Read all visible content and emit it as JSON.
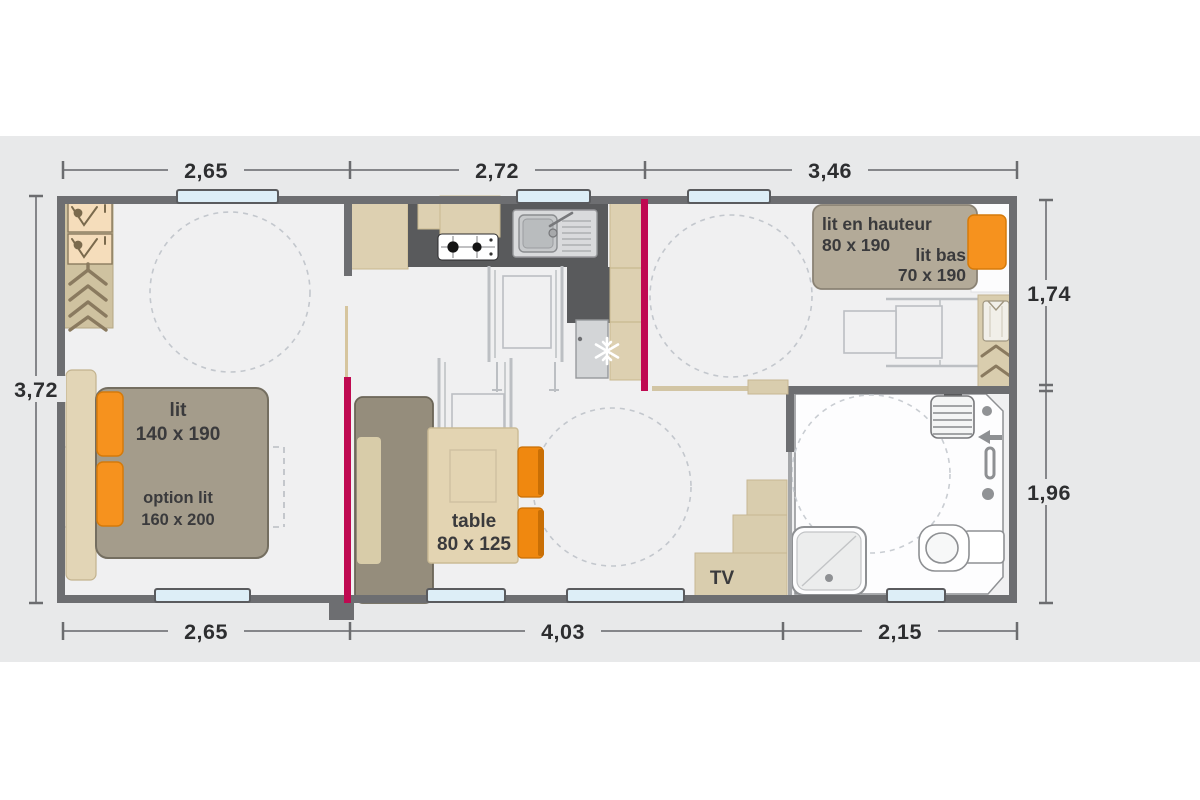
{
  "plan": {
    "dimensions": {
      "top": [
        "2,65",
        "2,72",
        "3,46"
      ],
      "bottom": [
        "2,65",
        "4,03",
        "2,15"
      ],
      "left": [
        "3,72"
      ],
      "right": [
        "1,74",
        "1,96"
      ]
    },
    "furniture": {
      "bed": {
        "name": "lit",
        "size": "140 x 190"
      },
      "bed_option": {
        "name": "option lit",
        "size": "160 x 200"
      },
      "table": {
        "name": "table",
        "size": "80 x 125"
      },
      "tv": {
        "name": "TV"
      },
      "bunk_bed": {
        "name": "lit en hauteur",
        "size": "80 x 190"
      },
      "low_bed": {
        "name": "lit bas",
        "size": "70 x 190"
      }
    },
    "colors": {
      "accent_orange": "#f6921e",
      "door_magenta": "#bf0a51",
      "wall_gray": "#6d6e71",
      "window_blue": "#ddeef7",
      "cabinet_beige": "#ddd0b1",
      "upholstery_taupe": "#a49c8b"
    }
  }
}
